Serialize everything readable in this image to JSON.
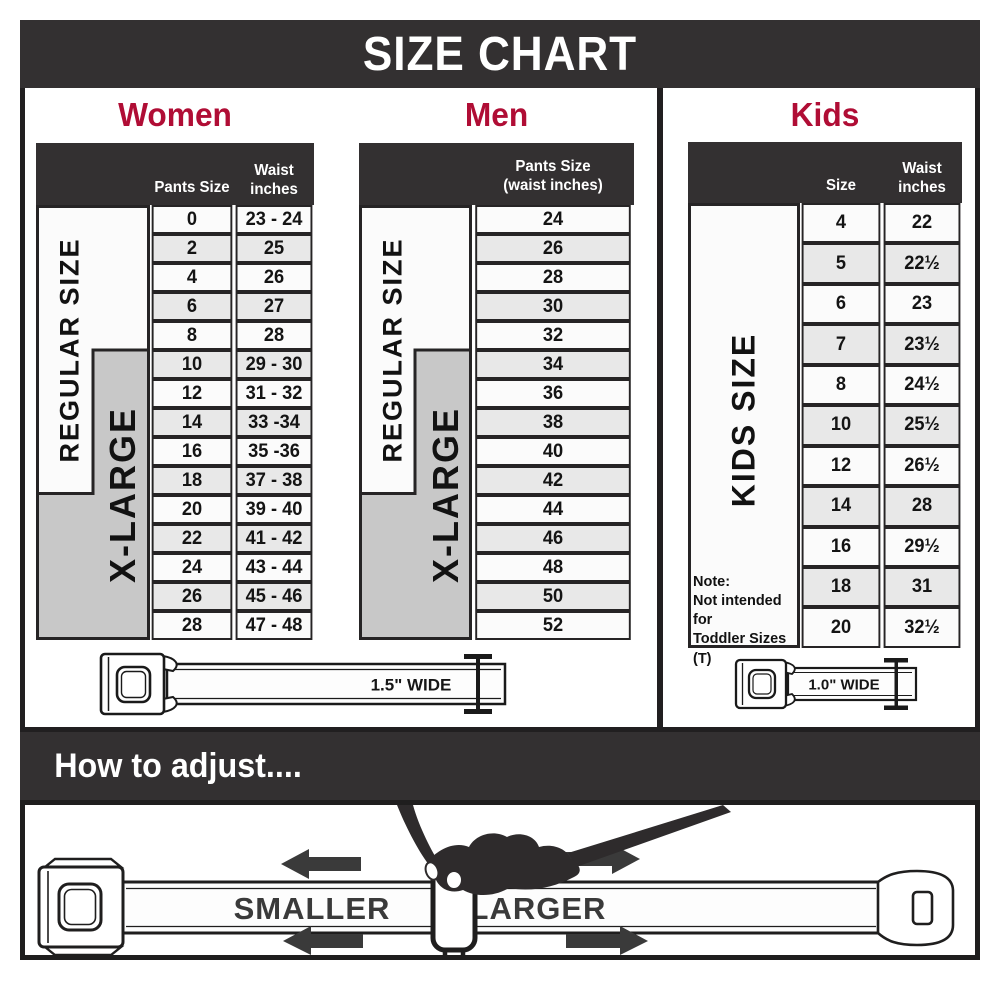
{
  "title": "SIZE CHART",
  "palette": {
    "dark_band": "#333031",
    "accent_red": "#b00d35",
    "xlarge_gray": "#c8c8c8",
    "row_alt_gray": "#e8e8e8",
    "line_black": "#262425"
  },
  "women": {
    "heading": "Women",
    "header": {
      "col1": "Pants Size",
      "col2": "Waist\ninches"
    },
    "regular_label": "REGULAR SIZE",
    "xlarge_label": "X-LARGE",
    "rows": [
      [
        "0",
        "23 - 24"
      ],
      [
        "2",
        "25"
      ],
      [
        "4",
        "26"
      ],
      [
        "6",
        "27"
      ],
      [
        "8",
        "28"
      ],
      [
        "10",
        "29 - 30"
      ],
      [
        "12",
        "31 - 32"
      ],
      [
        "14",
        "33 -34"
      ],
      [
        "16",
        "35 -36"
      ],
      [
        "18",
        "37 - 38"
      ],
      [
        "20",
        "39 - 40"
      ],
      [
        "22",
        "41 - 42"
      ],
      [
        "24",
        "43 - 44"
      ],
      [
        "26",
        "45 - 46"
      ],
      [
        "28",
        "47 - 48"
      ]
    ]
  },
  "men": {
    "heading": "Men",
    "header": {
      "col1": "Pants Size\n(waist inches)"
    },
    "regular_label": "REGULAR SIZE",
    "xlarge_label": "X-LARGE",
    "rows": [
      "24",
      "26",
      "28",
      "30",
      "32",
      "34",
      "36",
      "38",
      "40",
      "42",
      "44",
      "46",
      "48",
      "50",
      "52"
    ]
  },
  "kids": {
    "heading": "Kids",
    "header": {
      "col1": "Size",
      "col2": "Waist\ninches"
    },
    "side_label": "KIDS SIZE",
    "note": {
      "title": "Note:",
      "body": "Not intended for\nToddler Sizes (T)"
    },
    "rows": [
      [
        "4",
        "22"
      ],
      [
        "5",
        "22½"
      ],
      [
        "6",
        "23"
      ],
      [
        "7",
        "23½"
      ],
      [
        "8",
        "24½"
      ],
      [
        "10",
        "25½"
      ],
      [
        "12",
        "26½"
      ],
      [
        "14",
        "28"
      ],
      [
        "16",
        "29½"
      ],
      [
        "18",
        "31"
      ],
      [
        "20",
        "32½"
      ]
    ]
  },
  "belts": {
    "adult_width_label": "1.5\" WIDE",
    "kids_width_label": "1.0\" WIDE"
  },
  "adjust": {
    "heading": "How to adjust....",
    "smaller_label": "SMALLER",
    "larger_label": "LARGER"
  }
}
